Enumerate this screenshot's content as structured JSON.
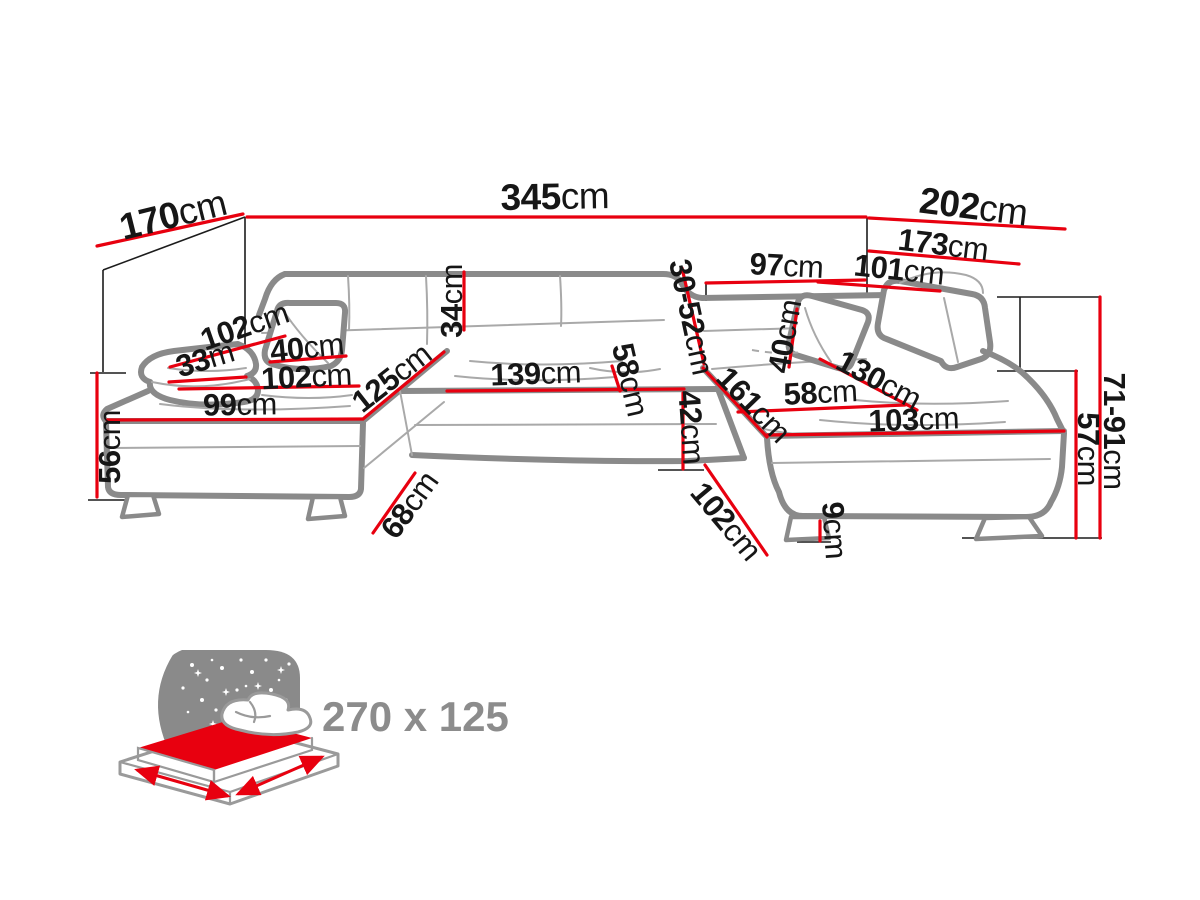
{
  "diagram": {
    "title": "U-shaped corner sofa dimension diagram",
    "unit_default": "cm",
    "colors": {
      "dimension": "#e8000f",
      "outline": "#8a8a8a",
      "text": "#161616",
      "muted": "#8c8c8c"
    },
    "icons": {
      "sleeping_area": "sleeping-function-bed-icon",
      "stars": "night-stars-icon",
      "moon": "moon-crescent-icon"
    },
    "dims": {
      "d170": {
        "v": "170",
        "u": "cm"
      },
      "d345": {
        "v": "345",
        "u": "cm"
      },
      "d202": {
        "v": "202",
        "u": "cm"
      },
      "d173": {
        "v": "173",
        "u": "cm"
      },
      "d101": {
        "v": "101",
        "u": "cm"
      },
      "d97": {
        "v": "97",
        "u": "cm"
      },
      "d30_52": {
        "v": "30-52",
        "u": "cm"
      },
      "d34": {
        "v": "34",
        "u": "cm"
      },
      "d102a": {
        "v": "102",
        "u": "cm"
      },
      "d33": {
        "v": "33",
        "u": "m"
      },
      "d40l": {
        "v": "40",
        "u": "cm"
      },
      "d102b": {
        "v": "102",
        "u": "cm"
      },
      "d99": {
        "v": "99",
        "u": "cm"
      },
      "d125": {
        "v": "125",
        "u": "cm"
      },
      "d139": {
        "v": "139",
        "u": "cm"
      },
      "d58m": {
        "v": "58",
        "u": "cm"
      },
      "d42": {
        "v": "42",
        "u": "cm"
      },
      "d56": {
        "v": "56",
        "u": "cm"
      },
      "d68": {
        "v": "68",
        "u": "cm"
      },
      "d161": {
        "v": "161",
        "u": "cm"
      },
      "d58r": {
        "v": "58",
        "u": "cm"
      },
      "d103": {
        "v": "103",
        "u": "cm"
      },
      "d130": {
        "v": "130",
        "u": "cm"
      },
      "d40r": {
        "v": "40",
        "u": "cm"
      },
      "d102c": {
        "v": "102",
        "u": "cm"
      },
      "d9": {
        "v": "9",
        "u": "cm"
      },
      "d71_91": {
        "v": "71-91",
        "u": "cm"
      },
      "d57": {
        "v": "57",
        "u": "cm"
      }
    },
    "sleeping_area": {
      "label": "270 x 125"
    }
  }
}
